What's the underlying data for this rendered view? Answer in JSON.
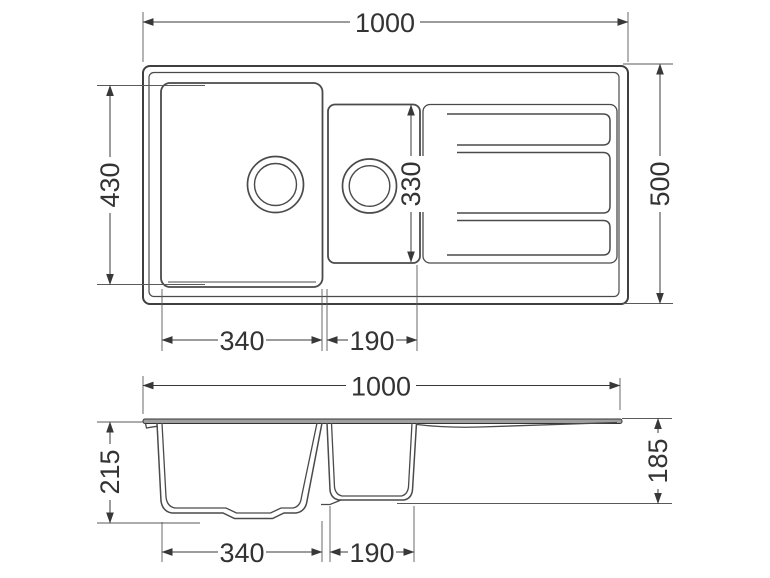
{
  "drawing": {
    "type": "technical-dimension-drawing",
    "subject": "kitchen sink with one and a half bowls and drainboard",
    "line_color": "#3f3f3f",
    "surface_fill": "#a0a0a0",
    "views": {
      "top_view": {
        "label": "plan view",
        "dimensions": {
          "overall_width": "1000",
          "overall_depth": "500",
          "main_bowl_front_depth": "430",
          "half_bowl_front_depth": "330",
          "main_bowl_width": "340",
          "half_bowl_width": "190"
        }
      },
      "front_view": {
        "label": "front section view",
        "dimensions": {
          "overall_width": "1000",
          "main_bowl_depth": "215",
          "half_bowl_depth": "185",
          "main_bowl_width": "340",
          "half_bowl_width": "190"
        }
      }
    }
  }
}
